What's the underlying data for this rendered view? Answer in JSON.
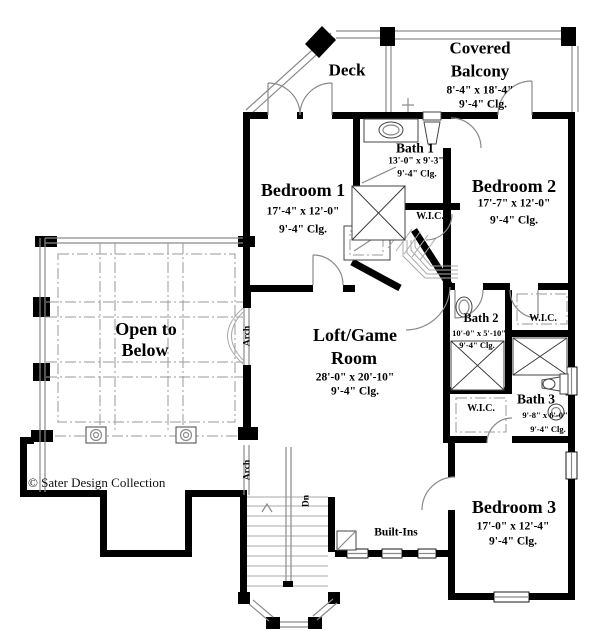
{
  "plan": {
    "rooms": {
      "deck": {
        "name": "Deck"
      },
      "covered_balcony": {
        "name_line1": "Covered",
        "name_line2": "Balcony",
        "dimensions": "8'-4\" x 18'-4\"",
        "ceiling": "9'-4\" Clg."
      },
      "bath_1": {
        "name": "Bath 1",
        "dimensions": "13'-0\" x 9'-3\"",
        "ceiling": "9'-4\" Clg."
      },
      "bedroom_1": {
        "name": "Bedroom 1",
        "dimensions": "17'-4\" x 12'-0\"",
        "ceiling": "9'-4\" Clg."
      },
      "bedroom_2": {
        "name": "Bedroom 2",
        "dimensions": "17'-7\" x 12'-0\"",
        "ceiling": "9'-4\" Clg."
      },
      "loft_game_room": {
        "name_line1": "Loft/Game",
        "name_line2": "Room",
        "dimensions": "28'-0\" x 20'-10\"",
        "ceiling": "9'-4\" Clg."
      },
      "open_to_below": {
        "name_line1": "Open to",
        "name_line2": "Below"
      },
      "bath_2": {
        "name": "Bath 2",
        "dimensions": "10'-0\" x 5'-10\"",
        "ceiling": "9'-4\" Clg."
      },
      "bath_3": {
        "name": "Bath 3",
        "dimensions": "9'-8\" x 6'-0\"",
        "ceiling": "9'-4\" Clg."
      },
      "bedroom_3": {
        "name": "Bedroom 3",
        "dimensions": "17'-0\" x 12'-4\"",
        "ceiling": "9'-4\" Clg."
      }
    },
    "annotations": {
      "wic": "W.I.C.",
      "arch": "Arch",
      "dn": "Dn",
      "built_ins": "Built-Ins"
    },
    "copyright": "© Sater Design Collection",
    "colors": {
      "wall": "#000000",
      "line": "#8a8a8a",
      "background": "#ffffff",
      "text": "#000000"
    }
  }
}
